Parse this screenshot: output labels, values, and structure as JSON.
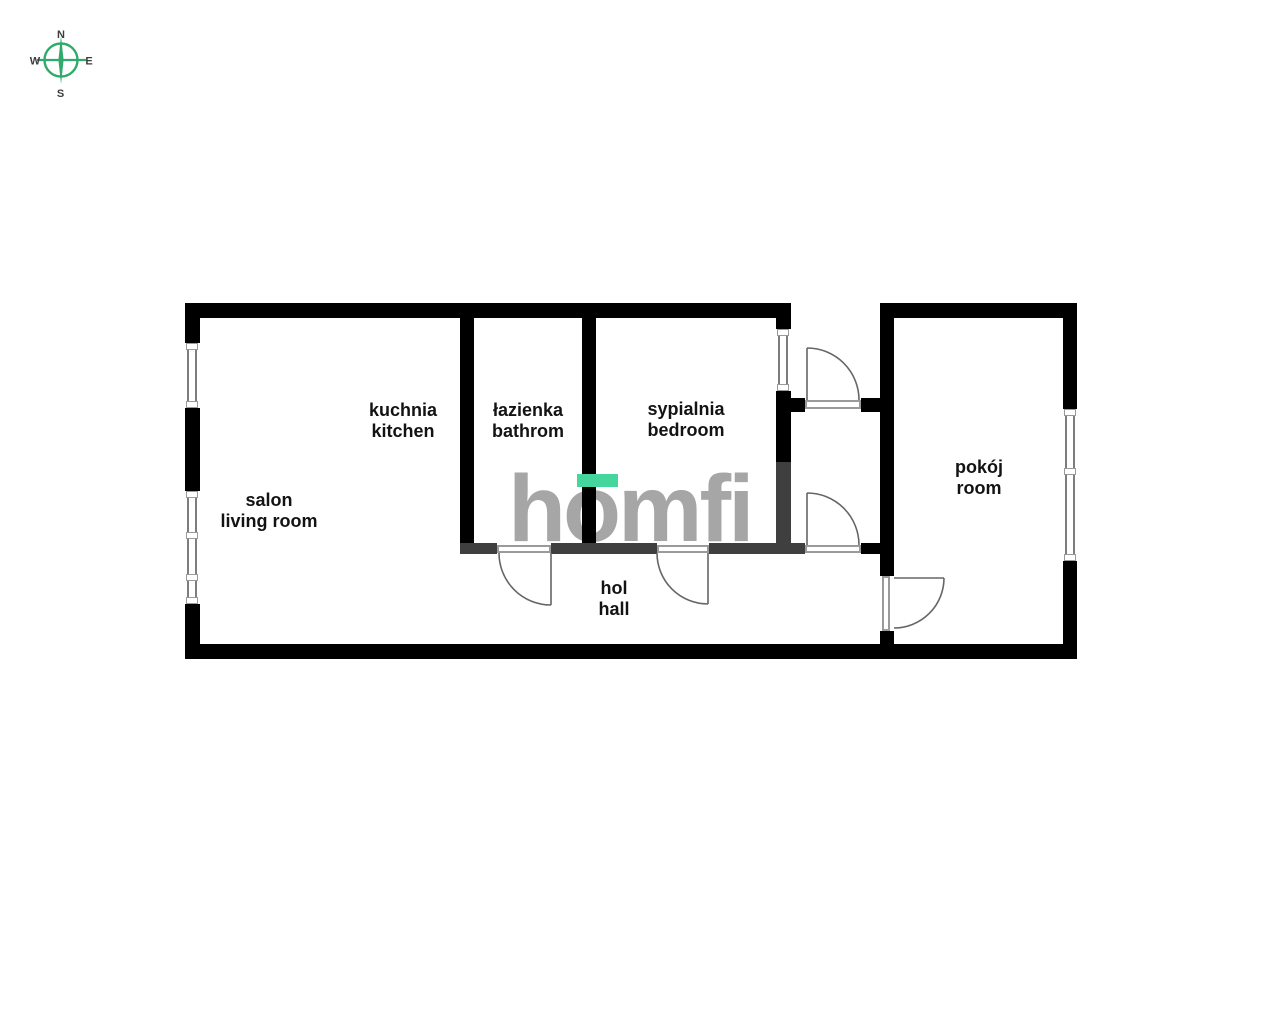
{
  "compass": {
    "north": "N",
    "west": "W",
    "east": "E",
    "south": "S",
    "accent_color": "#2faa6b",
    "label_color": "#3d3d3d"
  },
  "logo": {
    "text": "homfi",
    "text_color": "#a6a6a6",
    "accent_color": "#45d69e"
  },
  "rooms": [
    {
      "id": "living-room",
      "name_pl": "salon",
      "name_en": "living room"
    },
    {
      "id": "kitchen",
      "name_pl": "kuchnia",
      "name_en": "kitchen"
    },
    {
      "id": "bathroom",
      "name_pl": "łazienka",
      "name_en": "bathrom"
    },
    {
      "id": "bedroom",
      "name_pl": "sypialnia",
      "name_en": "bedroom"
    },
    {
      "id": "hall",
      "name_pl": "hol",
      "name_en": "hall"
    },
    {
      "id": "room",
      "name_pl": "pokój",
      "name_en": "room"
    }
  ],
  "plan_colors": {
    "exterior_wall": "#000000",
    "partition_wall": "#3f3f3f",
    "window_frame": "#7d7d7d",
    "door_line": "#666666"
  }
}
